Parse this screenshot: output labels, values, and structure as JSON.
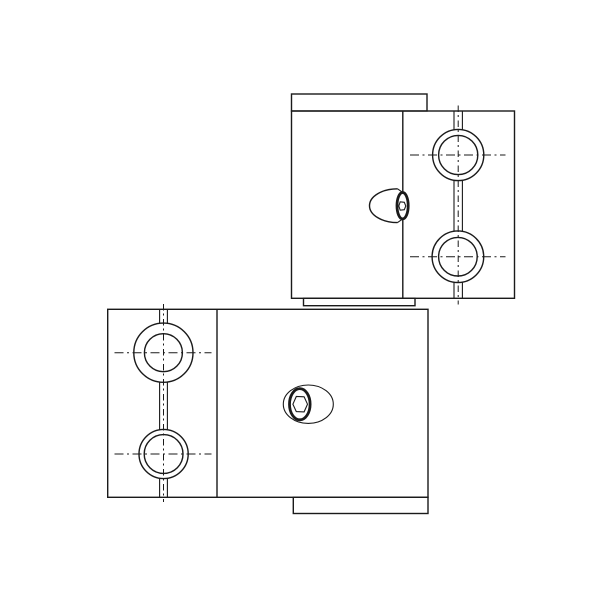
{
  "canvas": {
    "width": 600,
    "height": 600,
    "background": "#ffffff"
  },
  "style": {
    "line_color": "#1a1a1a",
    "outline_width": 1.4,
    "thin_width": 1.1,
    "centerline_width": 1,
    "bold_width": 2.8,
    "centerline_dash": "9 3.5 2 3.5",
    "slot_centerline_dash": "6.5 3 2 3.5"
  },
  "parts": [
    {
      "name": "upper-clamp-block",
      "shapes": [
        {
          "name": "top-boss-outline",
          "type": "rect",
          "attrs": {
            "x": 291.5,
            "y": 94,
            "width": 135.5,
            "height": 17
          }
        },
        {
          "name": "block-outline",
          "type": "rect",
          "attrs": {
            "x": 291.5,
            "y": 111,
            "width": 223,
            "height": 187.3
          }
        },
        {
          "name": "bottom-boss-outline",
          "type": "rect",
          "attrs": {
            "x": 303.5,
            "y": 298.3,
            "width": 111.5,
            "height": 7.4
          }
        },
        {
          "name": "face-division-edge",
          "type": "line",
          "attrs": {
            "x1": 402.8,
            "y1": 111,
            "x2": 402.8,
            "y2": 298.3
          }
        },
        {
          "name": "clamp-slot-left-edge",
          "type": "path",
          "attrs": {
            "d": "M454,111 V129.8 M454,180.3 V231.4 M454,282.1 V298.3"
          },
          "width_key": "thin_width"
        },
        {
          "name": "clamp-slot-right-edge",
          "type": "path",
          "attrs": {
            "d": "M462.4,111 V129.8 M462.4,180.3 V231.4 M462.4,282.1 V298.3"
          },
          "width_key": "thin_width"
        },
        {
          "name": "bore-vertical-centerline",
          "type": "line",
          "attrs": {
            "x1": 458.2,
            "y1": 105.5,
            "x2": 458.2,
            "y2": 304.5
          },
          "dash_key": "slot_centerline_dash",
          "width_key": "centerline_width"
        },
        {
          "name": "upper-bore-counterbore-circle",
          "type": "circle",
          "attrs": {
            "cx": 458.2,
            "cy": 155,
            "r": 25.6
          }
        },
        {
          "name": "upper-bore-hole-circle",
          "type": "circle",
          "attrs": {
            "cx": 458.2,
            "cy": 155,
            "r": 19.6
          }
        },
        {
          "name": "upper-bore-centerline",
          "type": "line",
          "attrs": {
            "x1": 410,
            "y1": 155,
            "x2": 505.5,
            "y2": 155
          },
          "dash_key": "centerline_dash",
          "width_key": "centerline_width"
        },
        {
          "name": "lower-bore-counterbore-circle",
          "type": "circle",
          "attrs": {
            "cx": 457.9,
            "cy": 256.7,
            "r": 25.8
          }
        },
        {
          "name": "lower-bore-hole-circle",
          "type": "circle",
          "attrs": {
            "cx": 457.9,
            "cy": 256.7,
            "r": 19.3
          }
        },
        {
          "name": "lower-bore-centerline",
          "type": "line",
          "attrs": {
            "x1": 410,
            "y1": 256.7,
            "x2": 505.5,
            "y2": 256.7
          },
          "dash_key": "centerline_dash",
          "width_key": "centerline_width"
        },
        {
          "name": "screw-head-dome",
          "type": "path",
          "attrs": {
            "d": "M397.5,188.8 A28,16.9 0 0 0 397.5,222.6"
          },
          "fill": "#ffffff"
        },
        {
          "name": "screw-head-top-edge",
          "type": "line",
          "attrs": {
            "x1": 397.5,
            "y1": 188.8,
            "x2": 404,
            "y2": 193.3
          },
          "width_key": "thin_width"
        },
        {
          "name": "screw-head-bottom-edge",
          "type": "line",
          "attrs": {
            "x1": 397.5,
            "y1": 222.6,
            "x2": 404,
            "y2": 218.1
          },
          "width_key": "thin_width"
        },
        {
          "name": "screw-socket-rim",
          "type": "ellipse",
          "attrs": {
            "cx": 402.6,
            "cy": 205.7,
            "rx": 5.6,
            "ry": 13.2
          },
          "fill": "#ffffff",
          "width_key": "bold_width"
        },
        {
          "name": "screw-hex-socket",
          "type": "polygon",
          "attrs": {
            "points": "398.8,206 400.2,201.8 404.3,202.3 405.8,206 404.3,209.7 400.2,210.2"
          },
          "width_key": "thin_width"
        }
      ]
    },
    {
      "name": "lower-clamp-block",
      "shapes": [
        {
          "name": "block-outline",
          "type": "rect",
          "attrs": {
            "x": 107.7,
            "y": 309.3,
            "width": 320.3,
            "height": 188
          }
        },
        {
          "name": "bottom-boss-outline",
          "type": "rect",
          "attrs": {
            "x": 293.3,
            "y": 497.3,
            "width": 134.7,
            "height": 16.2
          }
        },
        {
          "name": "face-division-edge",
          "type": "line",
          "attrs": {
            "x1": 217,
            "y1": 309.3,
            "x2": 217,
            "y2": 497.3
          }
        },
        {
          "name": "clamp-slot-left-edge",
          "type": "path",
          "attrs": {
            "d": "M159.6,309.3 V323.5 M159.6,382 V429.8 M159.6,478.2 V497.3"
          },
          "width_key": "thin_width"
        },
        {
          "name": "clamp-slot-right-edge",
          "type": "path",
          "attrs": {
            "d": "M167.4,309.3 V323.5 M167.4,382 V429.8 M167.4,478.2 V497.3"
          },
          "width_key": "thin_width"
        },
        {
          "name": "bore-vertical-centerline",
          "type": "line",
          "attrs": {
            "x1": 163.5,
            "y1": 304,
            "x2": 163.5,
            "y2": 502
          },
          "dash_key": "slot_centerline_dash",
          "width_key": "centerline_width"
        },
        {
          "name": "upper-bore-counterbore-circle",
          "type": "circle",
          "attrs": {
            "cx": 163.4,
            "cy": 352.7,
            "r": 29.6
          }
        },
        {
          "name": "upper-bore-hole-circle",
          "type": "circle",
          "attrs": {
            "cx": 163.4,
            "cy": 352.7,
            "r": 19
          }
        },
        {
          "name": "upper-bore-centerline",
          "type": "line",
          "attrs": {
            "x1": 114.5,
            "y1": 352.7,
            "x2": 211.5,
            "y2": 352.7
          },
          "dash_key": "centerline_dash",
          "width_key": "centerline_width"
        },
        {
          "name": "lower-bore-counterbore-circle",
          "type": "circle",
          "attrs": {
            "cx": 163.6,
            "cy": 454,
            "r": 24.6
          }
        },
        {
          "name": "lower-bore-hole-circle",
          "type": "circle",
          "attrs": {
            "cx": 163.6,
            "cy": 454,
            "r": 19.4
          }
        },
        {
          "name": "lower-bore-centerline",
          "type": "line",
          "attrs": {
            "x1": 114.5,
            "y1": 454,
            "x2": 211.5,
            "y2": 454
          },
          "dash_key": "centerline_dash",
          "width_key": "centerline_width"
        },
        {
          "name": "screw-head-outline",
          "type": "ellipse",
          "attrs": {
            "cx": 308.3,
            "cy": 404.2,
            "rx": 25,
            "ry": 19.2
          },
          "fill": "#ffffff",
          "width_key": "thin_width"
        },
        {
          "name": "screw-socket-rim",
          "type": "ellipse",
          "attrs": {
            "cx": 299.8,
            "cy": 404.2,
            "rx": 10.3,
            "ry": 15.6
          },
          "fill": "#ffffff",
          "width_key": "bold_width"
        },
        {
          "name": "screw-hex-socket",
          "type": "polygon",
          "attrs": {
            "points": "292.9,404.2 296.3,396.5 304.1,396.8 307.5,404.2 304.1,411.9 296.3,411.6"
          },
          "width_key": "thin_width"
        }
      ]
    }
  ]
}
